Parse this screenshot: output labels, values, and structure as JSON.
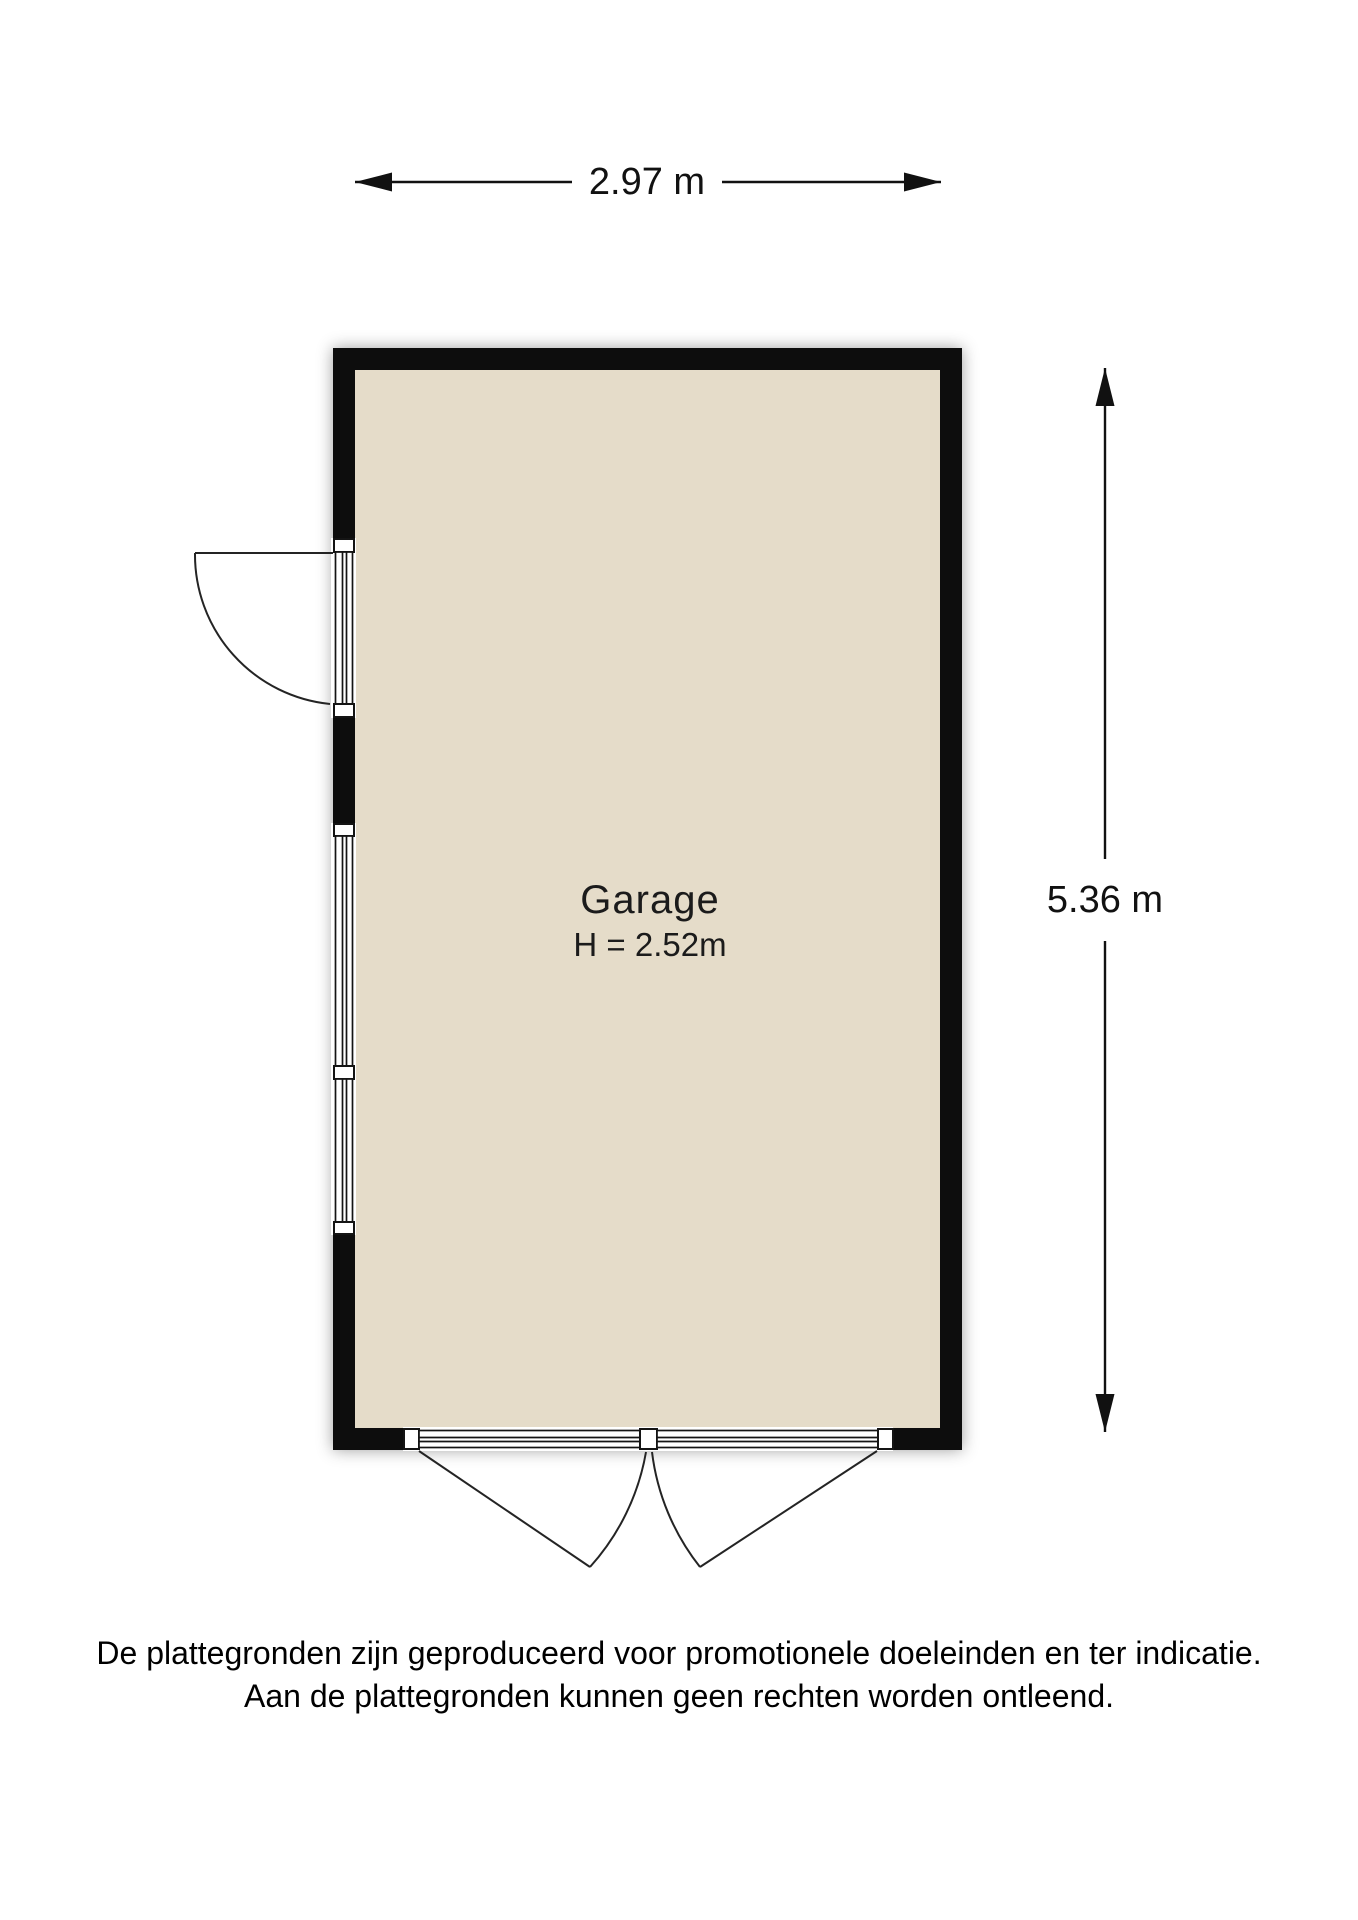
{
  "floorplan": {
    "room": {
      "name": "Garage",
      "height_label": "H = 2.52m"
    },
    "dimensions": {
      "width_label": "2.97 m",
      "height_label": "5.36 m"
    },
    "colors": {
      "wall": "#0a0a0a",
      "floor": "#e5dcc9",
      "background": "#ffffff"
    }
  },
  "disclaimer": {
    "line1": "De plattegronden zijn geproduceerd voor promotionele doeleinden en ter indicatie.",
    "line2": "Aan de plattegronden kunnen geen rechten worden ontleend."
  }
}
